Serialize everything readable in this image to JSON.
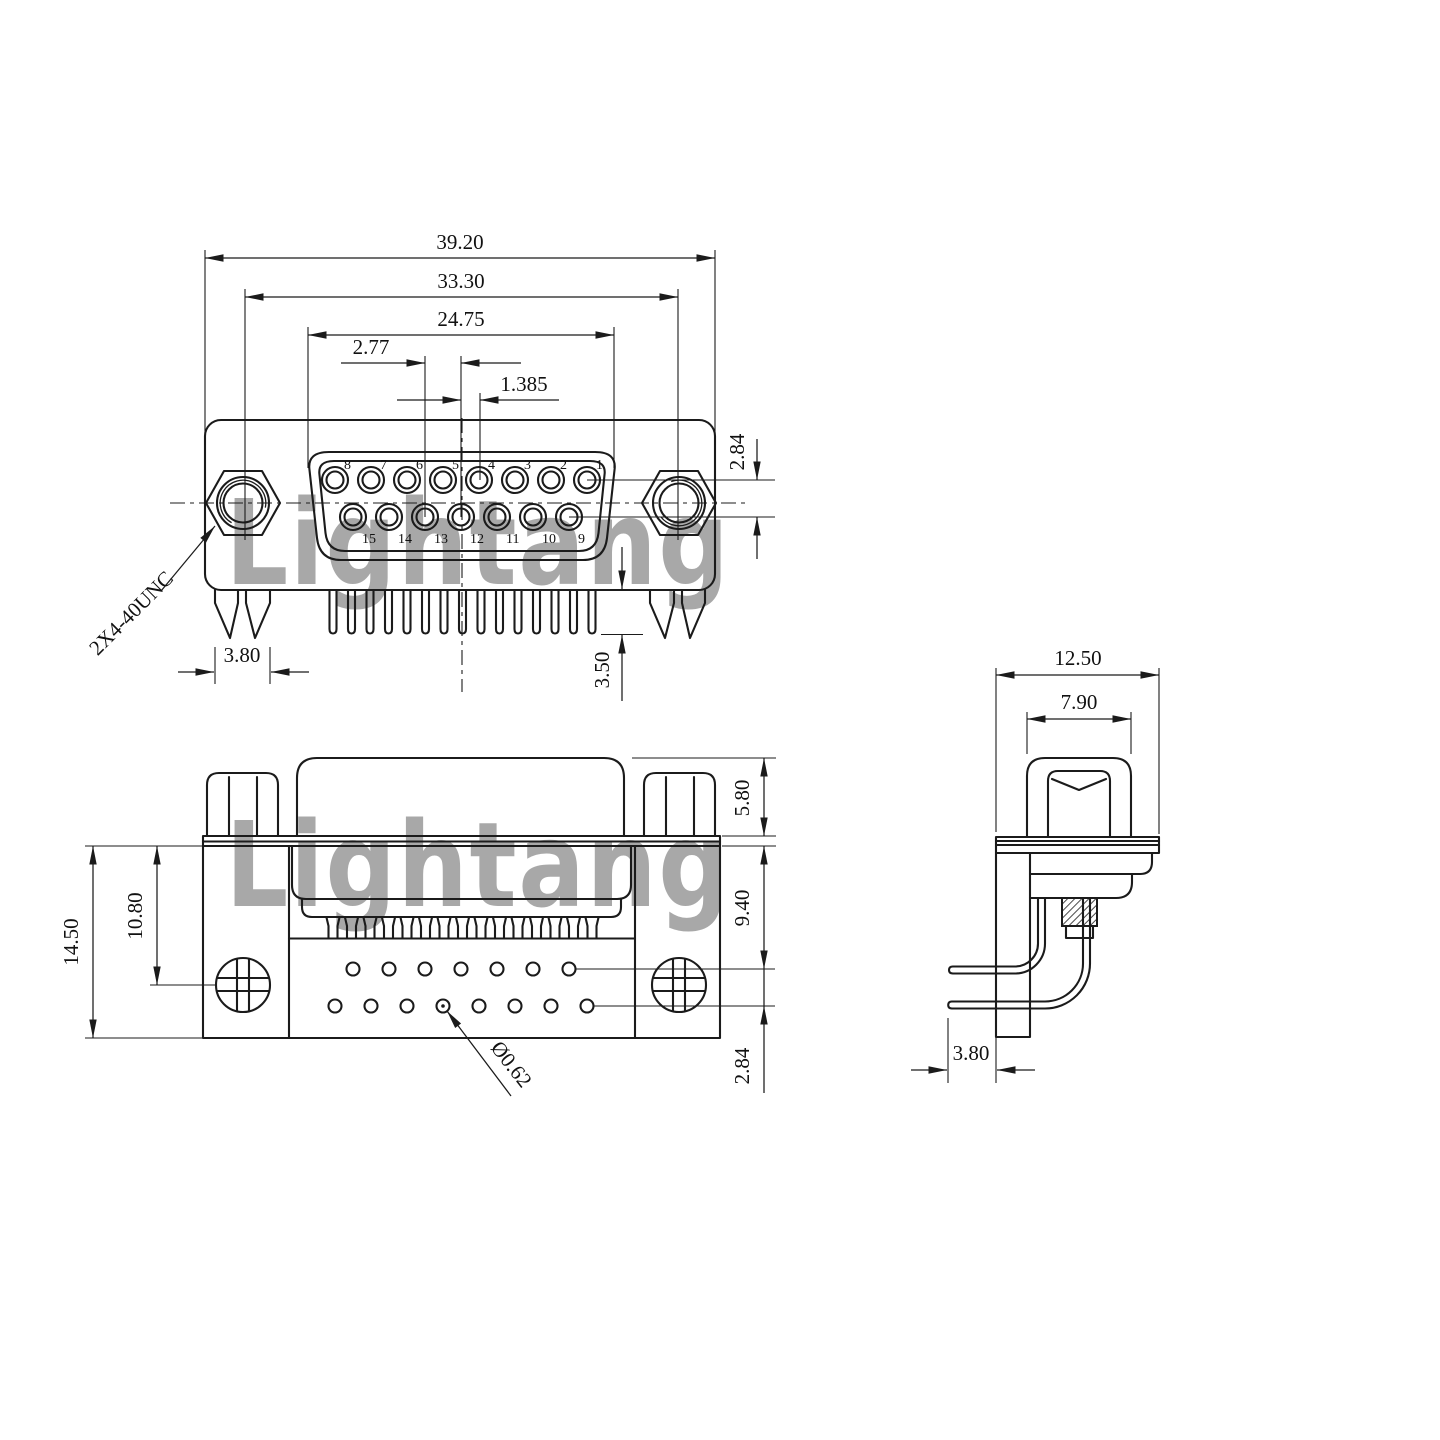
{
  "watermark": {
    "text": "Lightang",
    "color": "#e89898"
  },
  "front_view": {
    "dim_overall_width": "39.20",
    "dim_mount_hole_spacing": "33.30",
    "dim_shell_width": "24.75",
    "dim_contact_pitch": "2.77",
    "dim_row_stagger": "1.385",
    "dim_row_spacing": "2.84",
    "dim_bracket_leg_width": "3.80",
    "dim_tail_length": "3.50",
    "thread_label": "2X4-40UNC",
    "top_row_pin_labels": [
      "8",
      "7",
      "6",
      "5",
      "4",
      "3",
      "2",
      "1"
    ],
    "bottom_row_pin_labels": [
      "15",
      "14",
      "13",
      "12",
      "11",
      "10",
      "9"
    ]
  },
  "bottom_view": {
    "dim_body_height": "14.50",
    "dim_screw_center_height": "10.80",
    "dim_screw_boss_height": "5.80",
    "dim_insulator_height": "9.40",
    "dim_hole_row_spacing": "2.84",
    "hole_diameter_label": "Ø0.62",
    "top_hole_count": 7,
    "bottom_hole_count": 8
  },
  "side_view": {
    "dim_overall_depth": "12.50",
    "dim_screw_head_width": "7.90",
    "dim_pin_protrusion": "3.80"
  }
}
